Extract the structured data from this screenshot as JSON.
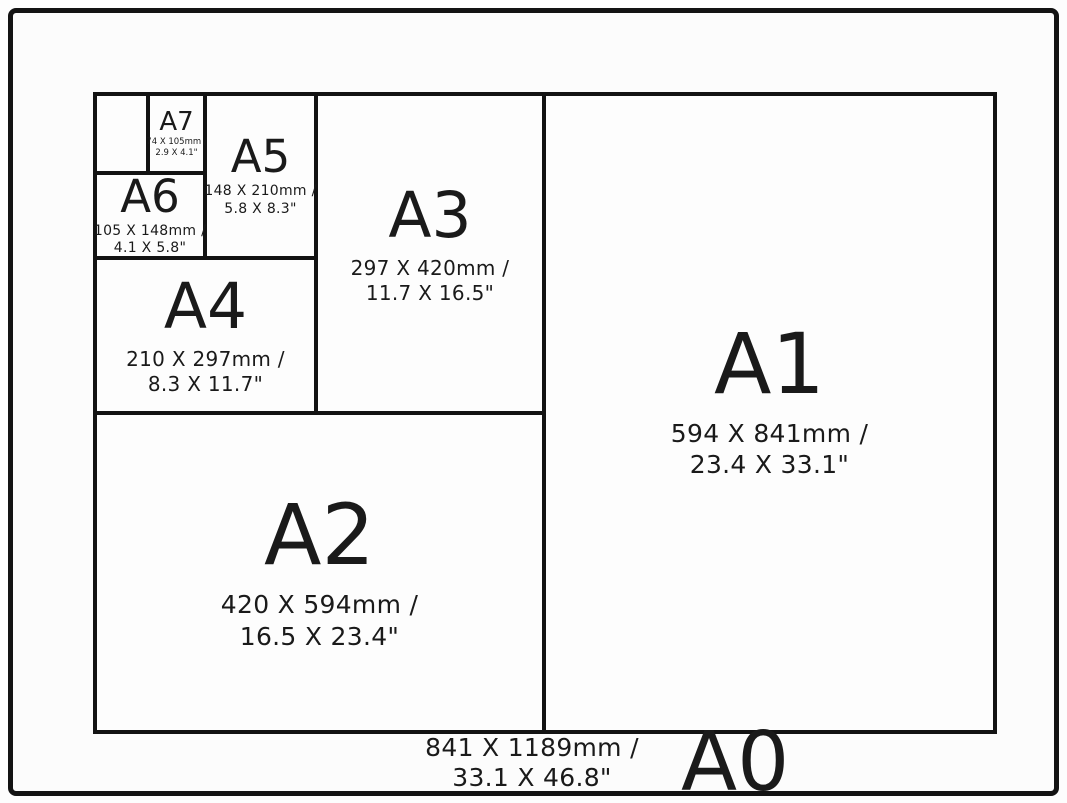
{
  "colors": {
    "line": "#131313",
    "text": "#1a1a1a",
    "background": "#fdfdfd"
  },
  "sizes": {
    "a0": {
      "label": "A0",
      "mm": "841 X 1189mm /",
      "inches": "33.1 X 46.8\""
    },
    "a1": {
      "label": "A1",
      "mm": "594 X 841mm /",
      "inches": "23.4 X 33.1\""
    },
    "a2": {
      "label": "A2",
      "mm": "420 X 594mm /",
      "inches": "16.5 X 23.4\""
    },
    "a3": {
      "label": "A3",
      "mm": "297 X 420mm /",
      "inches": "11.7 X 16.5\""
    },
    "a4": {
      "label": "A4",
      "mm": "210 X 297mm /",
      "inches": "8.3 X 11.7\""
    },
    "a5": {
      "label": "A5",
      "mm": "148 X 210mm /",
      "inches": "5.8 X 8.3\""
    },
    "a6": {
      "label": "A6",
      "mm": "105 X 148mm /",
      "inches": "4.1 X 5.8\""
    },
    "a7": {
      "label": "A7",
      "mm": "74 X 105mm /",
      "inches": "2.9 X 4.1\""
    }
  }
}
